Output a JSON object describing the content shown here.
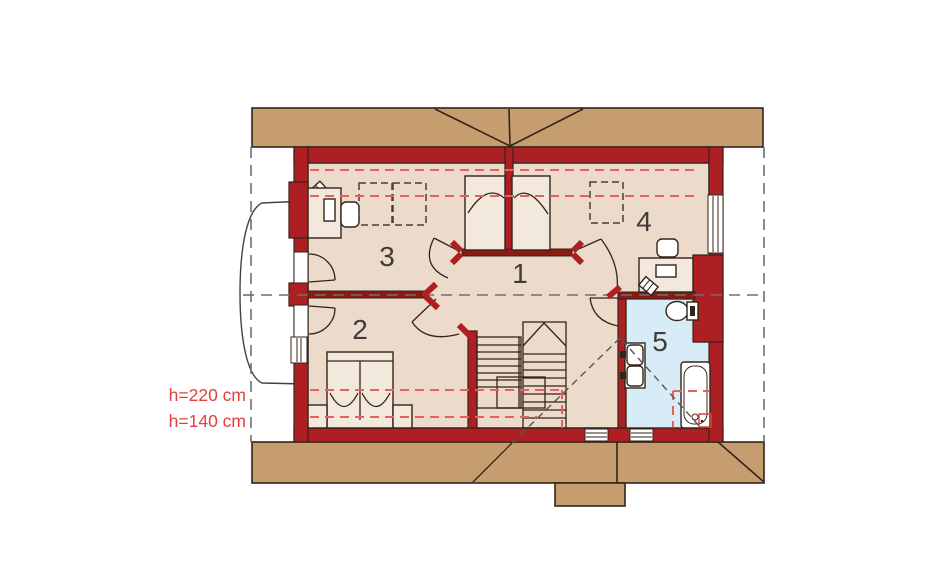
{
  "plan": {
    "type": "attic floor plan drawing",
    "rooms": [
      {
        "number": "1",
        "shape": "hallway"
      },
      {
        "number": "2",
        "shape": "bedroom with double bed"
      },
      {
        "number": "3",
        "shape": "room with desk and skylight outlines"
      },
      {
        "number": "4",
        "shape": "room with desk and skylight outline"
      },
      {
        "number": "5",
        "shape": "bathroom with tub, twin basins, toilet"
      }
    ],
    "annotations": {
      "height_line_1": "h=220 cm",
      "height_line_2": "h=140 cm"
    },
    "elements": [
      "roof-band-top",
      "roof-band-bottom",
      "chimney",
      "eyebrow-dormer",
      "staircase",
      "wardrobes",
      "bed",
      "nightstands",
      "desks",
      "chairs",
      "bathtub",
      "washbasins",
      "toilet",
      "windows",
      "doors",
      "height-dashed-lines",
      "section-dashed-lines",
      "roof-slope-diagonals"
    ]
  },
  "colors": {
    "roof": "#c69d6e",
    "floor": "#ecdacb",
    "furniture": "#f2e8dc",
    "wall": "#ae1f23",
    "wall_dark": "#8a1a12",
    "bath": "#d8ecf8",
    "outline": "#33241a",
    "dash_gray": "#6f6f6f",
    "dash_red": "#e4615e",
    "label_red": "#e2403e",
    "number_ink": "#3f3b38"
  }
}
